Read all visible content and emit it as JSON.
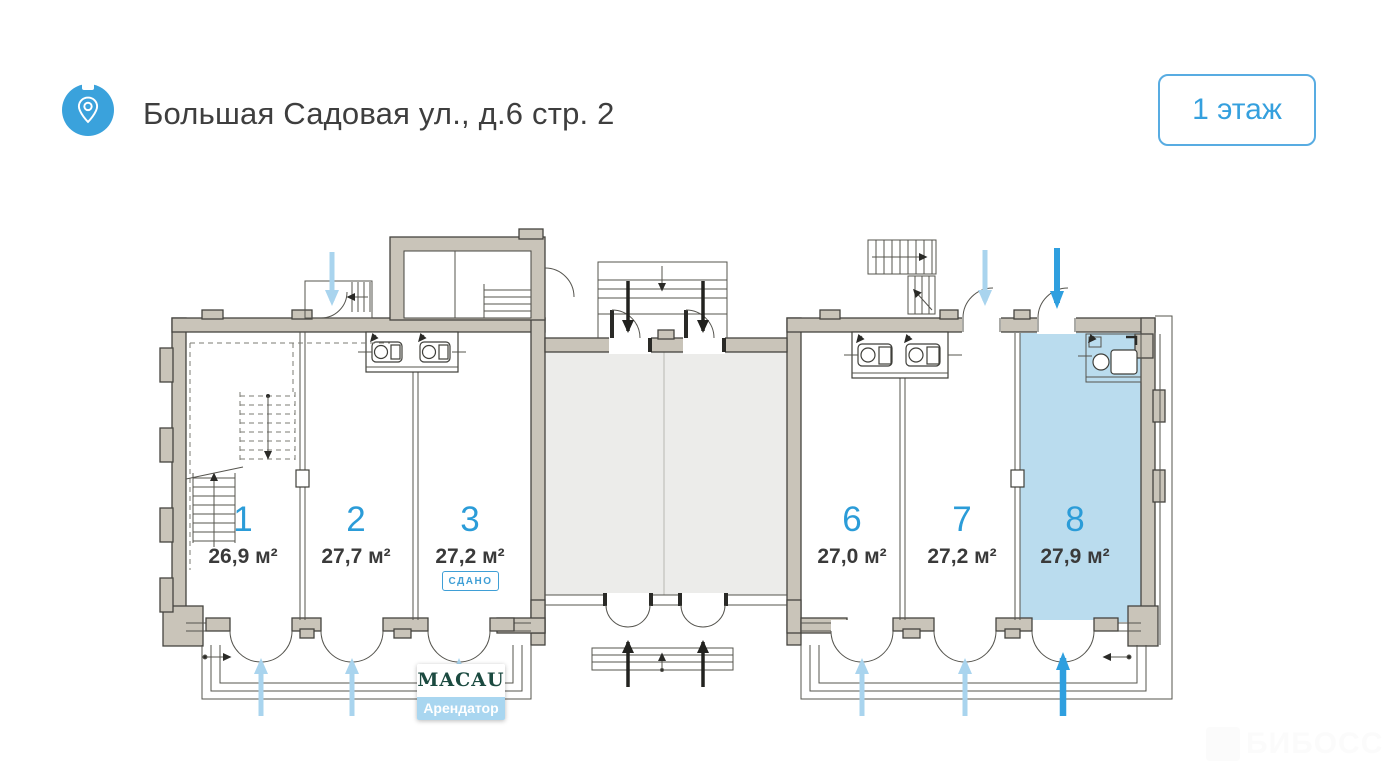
{
  "header": {
    "title": "Большая Садовая ул., д.6 стр. 2",
    "location_icon": "location-pin",
    "floor_button": "1 этаж"
  },
  "plan": {
    "rooms": [
      {
        "number": "1",
        "area": "26,9 м²",
        "status": "",
        "highlighted": false,
        "entry_arrow": "light-blue"
      },
      {
        "number": "2",
        "area": "27,7 м²",
        "status": "",
        "highlighted": false,
        "entry_arrow": "light-blue"
      },
      {
        "number": "3",
        "area": "27,2 м²",
        "status": "СДАНО",
        "highlighted": false,
        "entry_arrow": "light-blue"
      },
      {
        "number": "6",
        "area": "27,0 м²",
        "status": "",
        "highlighted": false,
        "entry_arrow": "light-blue"
      },
      {
        "number": "7",
        "area": "27,2 м²",
        "status": "",
        "highlighted": false,
        "entry_arrow": "light-blue"
      },
      {
        "number": "8",
        "area": "27,9 м²",
        "status": "",
        "highlighted": true,
        "entry_arrow": "blue"
      }
    ],
    "tenant_card": {
      "name": "MACAU",
      "label": "Арендатор",
      "attached_to_room": "3"
    }
  },
  "watermark": {
    "text": "БИБОСС"
  },
  "colors": {
    "accent_blue": "#2f9fdf",
    "light_blue_arrow": "#a9d4ee",
    "room_highlight_fill": "#badcee",
    "hall_fill": "#ececea",
    "wall_fill": "#c9c4b9",
    "room_number_blue": "#2b9cd8",
    "badge_blue": "#3f9fd6",
    "tenant_green": "#1b4a40",
    "tenant_label_bg": "#a9d6f0",
    "text_dark": "#3a3a3a"
  }
}
